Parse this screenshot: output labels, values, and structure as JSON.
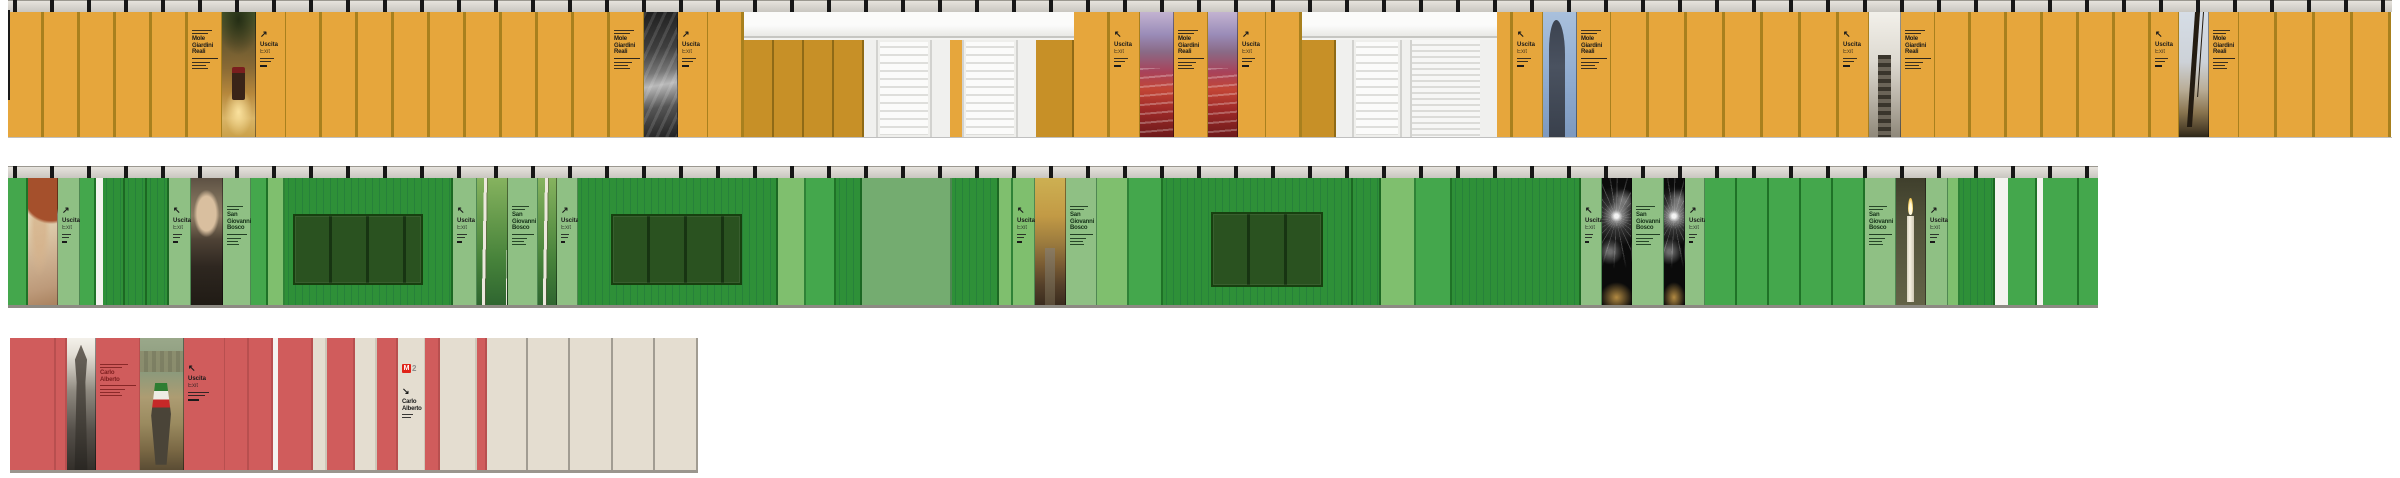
{
  "labels": {
    "mole": [
      "Mole",
      "Giardini",
      "Reali"
    ],
    "bosco": [
      "San",
      "Giovanni",
      "Bosco"
    ],
    "carlo": [
      "Carlo",
      "Alberto"
    ],
    "uscita": [
      "Uscita",
      "Exit"
    ],
    "metro_m": "M",
    "metro_line": "2",
    "arrow_ne": "↗",
    "arrow_nw": "↖",
    "arrow_se": "↘"
  },
  "colors": {
    "yellow_panel": "#E6A63C",
    "yellow_divider": "#A8801E",
    "ochre_panel": "#C79027",
    "rail_gray": "#D8D5CF",
    "clamp_black": "#171717",
    "facade_white": "#F3F3F1",
    "green_mid": "#44A74C",
    "green_light": "#7FBF6E",
    "green_striped_dark": "#2E9038",
    "green_sage": "#8FC084",
    "green_blank": "#74AC70",
    "green_window": "#2A5220",
    "red_panel": "#D05C5C",
    "cream_panel": "#E4DDD0",
    "metro_red": "#E02318",
    "ink": "#1A1A1A",
    "ink_red": "#7E2020"
  },
  "photos": {
    "tram": "park-carriage-photo",
    "statue_bw": "sculpture-bw-photo",
    "seats": "theatre-red-seats-photo",
    "statue_sky": "statue-against-sky-photo",
    "staircase": "grand-staircase-photo",
    "tree_mole": "tree-and-mole-antonelliana-photo",
    "fresco": "fresco-angel-photo",
    "bosco_face": "don-bosco-portrait-photo",
    "birch": "birch-forest-photo",
    "autumn": "autumn-park-path-photo",
    "fireworks": "fireworks-night-photo",
    "candle": "candle-photo",
    "pharaoh": "egyptian-statue-bw-photo",
    "flag": "risorgimento-painting-photo"
  },
  "rows": {
    "yellow": {
      "segments": [
        {
          "t": "p",
          "v": "y",
          "w": 36,
          "r": 5
        },
        {
          "t": "dir",
          "l": "mole",
          "w": 34
        },
        {
          "t": "photo",
          "v": "tram",
          "w": 34
        },
        {
          "t": "exit",
          "a": "↗",
          "w": 30
        },
        {
          "t": "p",
          "v": "y",
          "w": 36,
          "r": 9
        },
        {
          "t": "dir",
          "l": "mole",
          "w": 34
        },
        {
          "t": "photo",
          "v": "statue_bw",
          "w": 34
        },
        {
          "t": "exit",
          "a": "↗",
          "w": 30
        },
        {
          "t": "p",
          "v": "y",
          "w": 36
        },
        {
          "t": "facade",
          "w": 330,
          "sub": [
            {
              "t": "p",
              "v": "o",
              "w": 30,
              "r": 4
            },
            {
              "t": "wall",
              "w": 12
            },
            {
              "t": "louver",
              "w": 56
            },
            {
              "t": "wall",
              "w": 18
            },
            {
              "t": "p",
              "v": "y",
              "w": 12
            },
            {
              "t": "louver",
              "w": 56
            },
            {
              "t": "wall",
              "w": 18
            },
            {
              "t": "p",
              "v": "o",
              "w": 38
            }
          ]
        },
        {
          "t": "p",
          "v": "y",
          "w": 36
        },
        {
          "t": "exit",
          "a": "↖",
          "w": 30
        },
        {
          "t": "photo",
          "v": "seats",
          "w": 34
        },
        {
          "t": "dir",
          "l": "mole",
          "w": 34
        },
        {
          "t": "photo",
          "v": "seats",
          "w": 30
        },
        {
          "t": "exit",
          "a": "↗",
          "w": 28
        },
        {
          "t": "p",
          "v": "y",
          "w": 36
        },
        {
          "t": "facade",
          "w": 195,
          "sub": [
            {
              "t": "p",
              "v": "o",
              "w": 34
            },
            {
              "t": "wall",
              "w": 16
            },
            {
              "t": "louver",
              "w": 50
            },
            {
              "t": "wall",
              "w": 8
            },
            {
              "t": "shutter",
              "w": 70
            },
            {
              "t": "wall",
              "w": 17
            }
          ]
        },
        {
          "t": "p",
          "v": "y",
          "w": 16
        },
        {
          "t": "exit",
          "a": "↖",
          "w": 30
        },
        {
          "t": "photo",
          "v": "statue_sky",
          "w": 34
        },
        {
          "t": "dir",
          "l": "mole",
          "w": 34
        },
        {
          "t": "p",
          "v": "y",
          "w": 38,
          "r": 6
        },
        {
          "t": "exit",
          "a": "↖",
          "w": 30
        },
        {
          "t": "photo",
          "v": "staircase",
          "w": 32
        },
        {
          "t": "dir",
          "l": "mole",
          "w": 34
        },
        {
          "t": "p",
          "v": "y",
          "w": 36,
          "r": 6
        },
        {
          "t": "exit",
          "a": "↖",
          "w": 28
        },
        {
          "t": "photo",
          "v": "tree_mole",
          "w": 30
        },
        {
          "t": "dir",
          "l": "mole",
          "w": 30
        },
        {
          "t": "p",
          "v": "y",
          "w": 38,
          "r": 4
        }
      ]
    },
    "green": {
      "segments": [
        {
          "t": "p",
          "v": "g1",
          "w": 20
        },
        {
          "t": "photo",
          "v": "fresco",
          "w": 30
        },
        {
          "t": "exit",
          "a": "↗",
          "v": "g4",
          "w": 22
        },
        {
          "t": "p",
          "v": "g1",
          "w": 16
        },
        {
          "t": "gap",
          "w": 7
        },
        {
          "t": "p",
          "v": "g3",
          "w": 22,
          "r": 3
        },
        {
          "t": "exit",
          "a": "↖",
          "v": "g4",
          "w": 22
        },
        {
          "t": "photo",
          "v": "bosco_face",
          "w": 32
        },
        {
          "t": "dir",
          "l": "bosco",
          "v": "g4",
          "c": "clr-green",
          "w": 28
        },
        {
          "t": "p",
          "v": "g1",
          "w": 17
        },
        {
          "t": "p",
          "v": "g2",
          "w": 17
        },
        {
          "t": "win",
          "w": 168,
          "inset": [
            36,
            28,
            20,
            8
          ]
        },
        {
          "t": "exit",
          "a": "↖",
          "v": "g4",
          "w": 24
        },
        {
          "t": "photo",
          "v": "birch",
          "w": 31
        },
        {
          "t": "dir",
          "l": "bosco",
          "v": "g4",
          "c": "clr-green",
          "w": 30
        },
        {
          "t": "photo",
          "v": "birch",
          "w": 19
        },
        {
          "t": "exit",
          "a": "↗",
          "v": "g4",
          "w": 21
        },
        {
          "t": "win",
          "w": 200,
          "inset": [
            36,
            34,
            20,
            33
          ]
        },
        {
          "t": "p",
          "v": "g2",
          "w": 28
        },
        {
          "t": "p",
          "v": "g1",
          "w": 30
        },
        {
          "t": "p",
          "v": "g3",
          "w": 26
        },
        {
          "t": "p",
          "v": "g5",
          "w": 90
        },
        {
          "t": "p",
          "v": "g3",
          "w": 47
        },
        {
          "t": "p",
          "v": "g2",
          "w": 14
        },
        {
          "t": "exit",
          "a": "↖",
          "v": "g2",
          "w": 22
        },
        {
          "t": "photo",
          "v": "autumn",
          "w": 31
        },
        {
          "t": "dir",
          "l": "bosco",
          "v": "g4",
          "c": "clr-green",
          "w": 31
        },
        {
          "t": "p",
          "v": "g2",
          "w": 32
        },
        {
          "t": "p",
          "v": "g1",
          "w": 34
        },
        {
          "t": "win",
          "w": 190,
          "inset": [
            34,
            28,
            18,
            48
          ]
        },
        {
          "t": "p",
          "v": "g3",
          "w": 28
        },
        {
          "t": "p",
          "v": "g2",
          "w": 35
        },
        {
          "t": "p",
          "v": "g1",
          "w": 36
        },
        {
          "t": "p",
          "v": "g3",
          "w": 129
        },
        {
          "t": "exit",
          "a": "↖",
          "v": "g4",
          "w": 21
        },
        {
          "t": "photo",
          "v": "fireworks",
          "w": 30
        },
        {
          "t": "dir",
          "l": "bosco",
          "v": "g4",
          "c": "clr-green",
          "w": 32
        },
        {
          "t": "photo",
          "v": "fireworks",
          "w": 21
        },
        {
          "t": "exit",
          "a": "↗",
          "v": "g4",
          "w": 20
        },
        {
          "t": "p",
          "v": "g1",
          "w": 32,
          "r": 5
        },
        {
          "t": "dir",
          "l": "bosco",
          "v": "g4",
          "c": "clr-green",
          "w": 31
        },
        {
          "t": "photo",
          "v": "candle",
          "w": 30
        },
        {
          "t": "exit",
          "a": "↗",
          "v": "g4",
          "w": 22
        },
        {
          "t": "p",
          "v": "g2",
          "w": 12
        },
        {
          "t": "p",
          "v": "g3",
          "w": 35
        },
        {
          "t": "gap",
          "w": 13
        },
        {
          "t": "p",
          "v": "g1",
          "w": 29
        },
        {
          "t": "gap",
          "w": 6
        },
        {
          "t": "p",
          "v": "g1",
          "w": 36
        },
        {
          "t": "p",
          "v": "g1",
          "w": 25
        }
      ]
    },
    "red": {
      "segments": [
        {
          "t": "p",
          "v": "r",
          "w": 46
        },
        {
          "t": "p",
          "v": "r",
          "w": 11
        },
        {
          "t": "photo",
          "v": "pharaoh",
          "w": 29
        },
        {
          "t": "dir",
          "l": "carlo",
          "v": "r",
          "c": "clr-red",
          "w": 44
        },
        {
          "t": "photo",
          "v": "flag",
          "w": 44
        },
        {
          "t": "exit",
          "a": "↖",
          "v": "r",
          "w": 41
        },
        {
          "t": "p",
          "v": "r",
          "w": 24,
          "r": 2
        },
        {
          "t": "gap",
          "w": 5
        },
        {
          "t": "p",
          "v": "r",
          "w": 35
        },
        {
          "t": "p",
          "v": "c",
          "w": 14
        },
        {
          "t": "p",
          "v": "r",
          "w": 28
        },
        {
          "t": "p",
          "v": "c",
          "w": 22
        },
        {
          "t": "p",
          "v": "r",
          "w": 21
        },
        {
          "t": "m2",
          "l": "carlo",
          "a": "↘",
          "w": 27
        },
        {
          "t": "p",
          "v": "r",
          "w": 15
        },
        {
          "t": "p",
          "v": "c",
          "w": 37
        },
        {
          "t": "p",
          "v": "r",
          "w": 10
        },
        {
          "t": "p",
          "v": "cs",
          "w": 41
        },
        {
          "t": "p",
          "v": "cs",
          "w": 42
        },
        {
          "t": "p",
          "v": "cs",
          "w": 43
        },
        {
          "t": "p",
          "v": "cs",
          "w": 42
        },
        {
          "t": "p",
          "v": "cs",
          "w": 43
        }
      ]
    }
  }
}
